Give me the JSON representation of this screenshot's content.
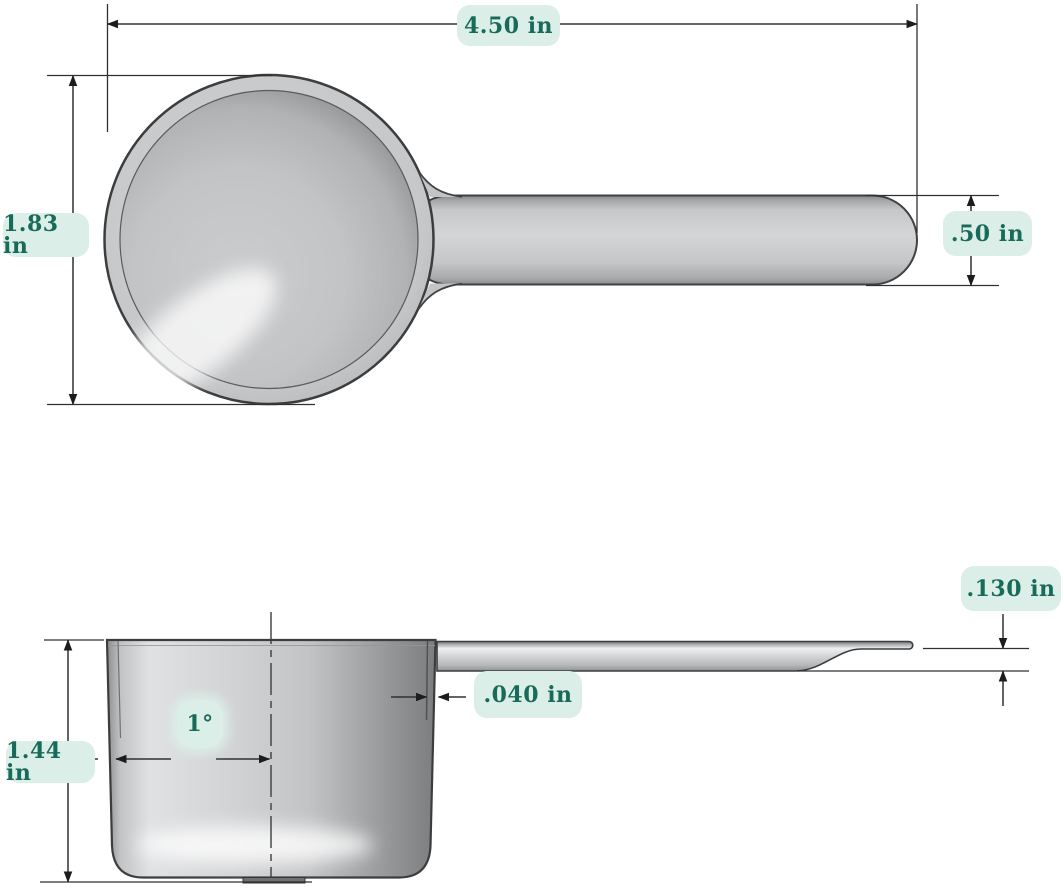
{
  "drawing": {
    "subject": "measuring scoop technical dimension drawing",
    "dimensions": {
      "overall_length": "4.50 in",
      "bowl_outer_diameter": "1.83 in",
      "handle_width": ".50 in",
      "handle_thickness": ".130 in",
      "wall_thickness": ".040 in",
      "bowl_height": "1.44 in",
      "draft_angle": "1°"
    },
    "colors": {
      "label_background": "#dbeee7",
      "label_text": "#186a5a",
      "dimension_line": "#2f3133",
      "outline": "#3b3d3f",
      "metal_light": "#e0e1e3",
      "metal_mid": "#c6c7c9",
      "metal_dark": "#7b7d7f",
      "page_background": "#ffffff"
    }
  }
}
